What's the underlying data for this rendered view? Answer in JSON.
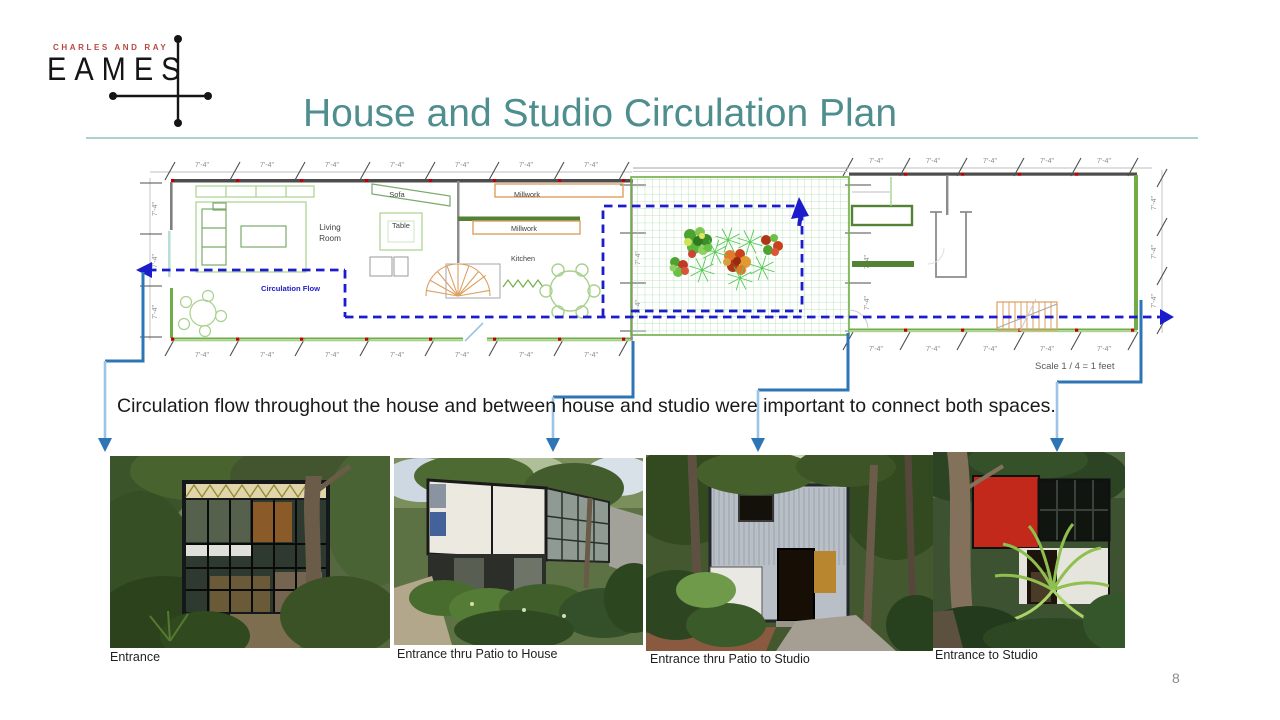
{
  "slide": {
    "logo": {
      "top_line": "CHARLES AND RAY",
      "name": "EAMES"
    },
    "title": "House and Studio Circulation Plan",
    "body_text": "Circulation flow throughout the house and between house and studio were important to connect both spaces.",
    "page_number": "8"
  },
  "plan": {
    "dim_label": "7'-4\"",
    "scale_label": "Scale   1 / 4 = 1 feet",
    "labels": {
      "living_room_line1": "Living",
      "living_room_line2": "Room",
      "circulation_flow": "Circulation Flow",
      "sofa": "Sofa",
      "table": "Table",
      "millwork": "Millwork",
      "kitchen": "Kitchen"
    }
  },
  "photos": [
    {
      "caption": "Entrance"
    },
    {
      "caption": "Entrance thru Patio to House"
    },
    {
      "caption": "Entrance thru Patio to Studio"
    },
    {
      "caption": "Entrance to Studio"
    }
  ],
  "theme": {
    "title_color": "#4f8e8e",
    "brand_red": "#b8473f",
    "divider_color": "#aed0d0",
    "flow_blue": "#1c1ccd",
    "connector_blue": "#2e75b6",
    "connector_light": "#9dc3e6",
    "wall_green": "#538135",
    "grid_green": "#a5dba5",
    "millwork_orange": "#dd9f60",
    "page_number_color": "#8c8c8c"
  }
}
